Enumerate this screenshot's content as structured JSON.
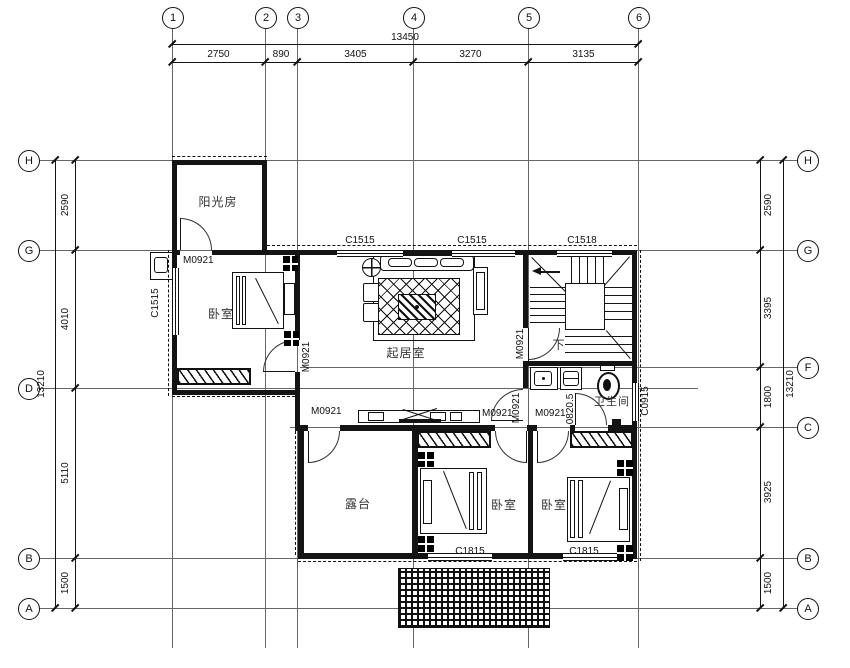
{
  "axes": {
    "top": [
      "1",
      "2",
      "3",
      "4",
      "5",
      "6"
    ],
    "left": [
      "H",
      "G",
      "D",
      "B",
      "A"
    ],
    "right": [
      "H",
      "G",
      "F",
      "C",
      "B",
      "A"
    ]
  },
  "dims": {
    "top_total": "13450",
    "top_segments": [
      "2750",
      "890",
      "3405",
      "3270",
      "3135"
    ],
    "left_total": "13210",
    "left_segments": [
      "2590",
      "4010",
      "5110",
      "1500"
    ],
    "right_total": "13210",
    "right_segments": [
      "2590",
      "3395",
      "1800",
      "3925",
      "1500"
    ]
  },
  "rooms": {
    "sunroom": "阳光房",
    "bedroom": "卧室",
    "living": "起居室",
    "bathroom": "卫生间",
    "terrace": "露台",
    "down": "下"
  },
  "openings": {
    "m0921": "M0921",
    "m0820": "0820.5",
    "c1515": "C1515",
    "c1518": "C1518",
    "c0915": "C0915",
    "c1815": "C1815"
  }
}
